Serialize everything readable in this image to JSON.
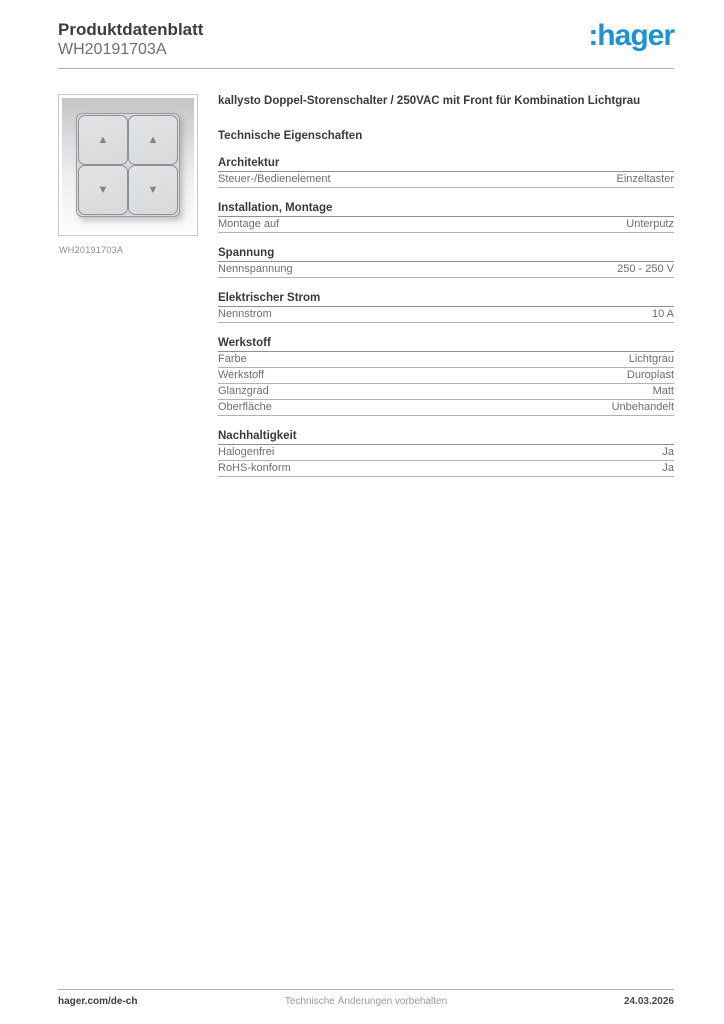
{
  "header": {
    "title": "Produktdatenblatt",
    "product_code": "WH20191703A",
    "logo_text": ":hager",
    "logo_color": "#1e93d2"
  },
  "product": {
    "description": "kallysto Doppel-Storenschalter / 250VAC mit Front für Kombination Lichtgrau",
    "image_caption": "WH20191703A"
  },
  "product_image": {
    "buttons": [
      "up",
      "up",
      "down",
      "down"
    ]
  },
  "icons": {
    "arrow_up": "▲",
    "arrow_down": "▼"
  },
  "specs": {
    "heading": "Technische Eigenschaften",
    "sections": [
      {
        "title": "Architektur",
        "rows": [
          {
            "label": "Steuer-/Bedienelement",
            "value": "Einzeltaster"
          }
        ]
      },
      {
        "title": "Installation, Montage",
        "rows": [
          {
            "label": "Montage auf",
            "value": "Unterputz"
          }
        ]
      },
      {
        "title": "Spannung",
        "rows": [
          {
            "label": "Nennspannung",
            "value": "250 - 250 V"
          }
        ]
      },
      {
        "title": "Elektrischer Strom",
        "rows": [
          {
            "label": "Nennstrom",
            "value": "10 A"
          }
        ]
      },
      {
        "title": "Werkstoff",
        "rows": [
          {
            "label": "Farbe",
            "value": "Lichtgrau"
          },
          {
            "label": "Werkstoff",
            "value": "Duroplast"
          },
          {
            "label": "Glanzgrad",
            "value": "Matt"
          },
          {
            "label": "Oberfläche",
            "value": "Unbehandelt"
          }
        ]
      },
      {
        "title": "Nachhaltigkeit",
        "rows": [
          {
            "label": "Halogenfrei",
            "value": "Ja"
          },
          {
            "label": "RoHS-konform",
            "value": "Ja"
          }
        ]
      }
    ]
  },
  "footer": {
    "left": "hager.com/de-ch",
    "center": "Technische Änderungen vorbehalten",
    "right": "24.03.2026"
  }
}
